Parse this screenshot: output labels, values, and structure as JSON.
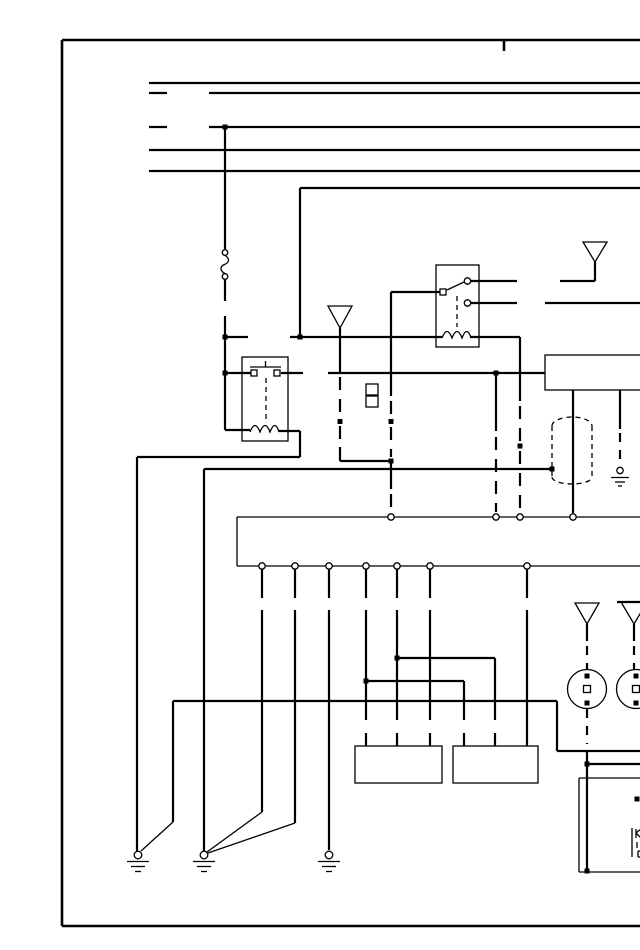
{
  "page": {
    "paper": "#ffffff",
    "ink": "#000000"
  },
  "diagram": {
    "kind": "wiring schematic",
    "visible_text": [],
    "components": [
      "power-bus-wires",
      "circuit-breaker",
      "relay-1",
      "relay-2",
      "antenna-symbol-top",
      "antenna-symbol-mid",
      "antenna-symbol-speaker-left",
      "antenna-symbol-speaker-right",
      "radio-unit-box",
      "shielded-antenna-lead",
      "inline-connector-gaps",
      "connector-block",
      "speaker-left",
      "speaker-right",
      "module-box-1",
      "module-box-2",
      "module-box-bottom-right",
      "ground-1",
      "ground-2",
      "ground-3",
      "ground-4"
    ]
  }
}
